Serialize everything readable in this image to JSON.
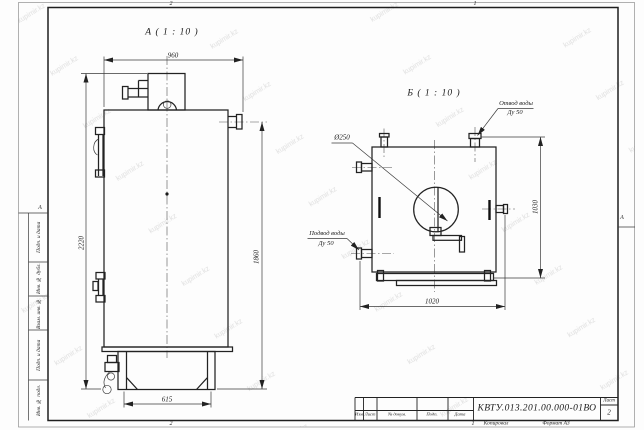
{
  "watermark": {
    "text": "kupimir.kz"
  },
  "sheet": {
    "zones": {
      "top_left": "2",
      "top_right": "1",
      "bottom_left": "2",
      "bottom_right": "1",
      "left": "А",
      "right": "А"
    }
  },
  "view_a": {
    "title": "А ( 1 : 10 )",
    "dims": {
      "top_width": "960",
      "overall_height": "2220",
      "outlet_height": "1860",
      "base_width": "615"
    }
  },
  "view_b": {
    "title": "Б ( 1 : 10 )",
    "dims": {
      "width": "1020",
      "height": "1030",
      "flue_diameter": "Ø250"
    },
    "outlet_label": {
      "line1": "Отвод воды",
      "line2": "Ду 50"
    },
    "inlet_label": {
      "line1": "Подвод воды",
      "line2": "Ду 50"
    }
  },
  "title_block": {
    "doc_number": "КВТУ.013.201.00.000-01ВО",
    "sheet_label": "Лист",
    "sheet_number": "2",
    "columns": [
      "Изм",
      "Лист",
      "№ докум.",
      "Подп.",
      "Дата"
    ],
    "copied_label": "Копировал",
    "format_label": "Формат А3"
  },
  "margin_strip": {
    "cells": [
      "Подп. и дата",
      "Инв. № дубл.",
      "Взам. инв. №",
      "Подп. и дата",
      "Инв. № подл."
    ]
  }
}
